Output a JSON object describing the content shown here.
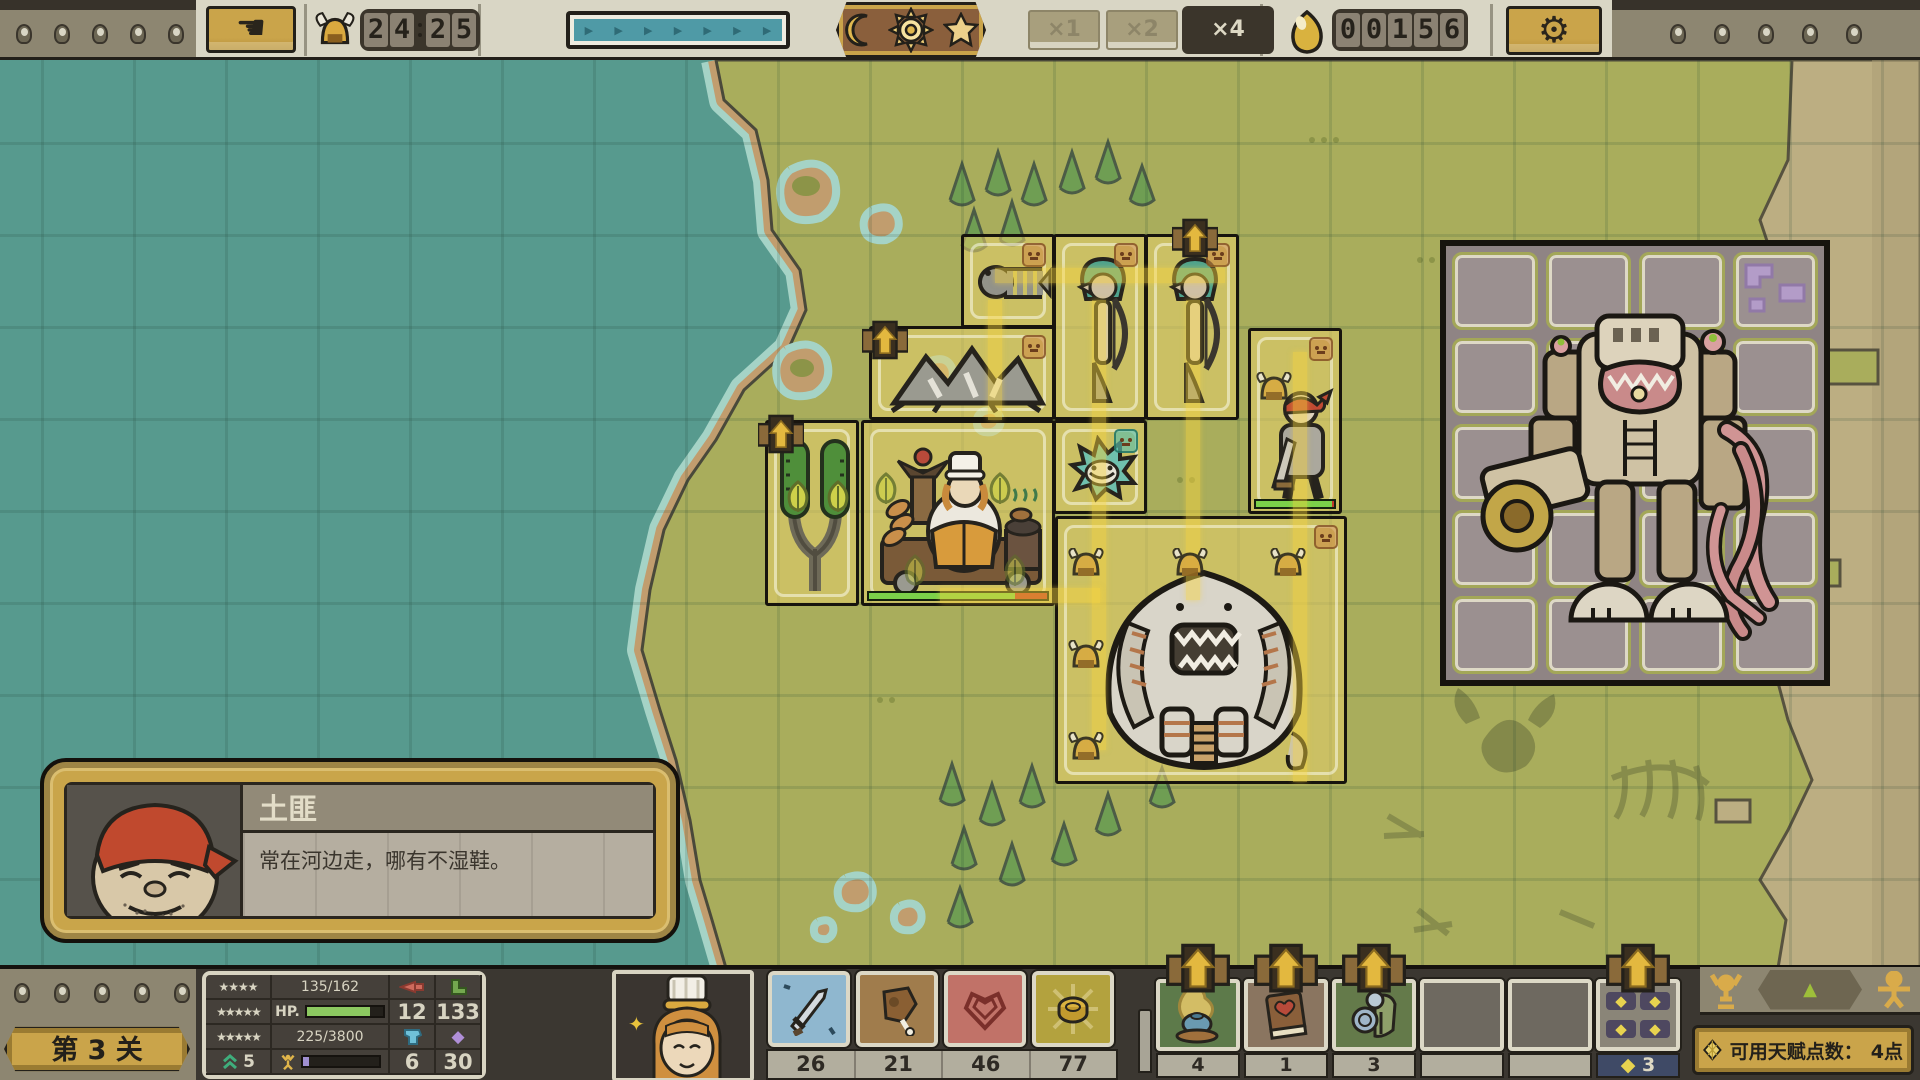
{
  "top_bar": {
    "wave_timer": {
      "digits": [
        "2",
        "4",
        "2",
        "5"
      ]
    },
    "speed_options": [
      {
        "label": "×1",
        "active": false
      },
      {
        "label": "×2",
        "active": false
      },
      {
        "label": "×4",
        "active": true
      }
    ],
    "gold_counter": {
      "digits": [
        "0",
        "0",
        "1",
        "5",
        "6"
      ]
    }
  },
  "map": {
    "units": [
      "fish-skeleton",
      "mermaid-archer",
      "mermaid-archer",
      "rock-spider",
      "slingshot-tree",
      "chef-wagon",
      "bandit-swordsman",
      "spike-fish",
      "behemoth-boss",
      "scrap-mech"
    ]
  },
  "dialog": {
    "title": "土匪",
    "description": "常在河边走，哪有不湿鞋。"
  },
  "bottom_bar": {
    "level_label": "第 3 关",
    "stats": {
      "stars_row1": "★★★★",
      "stars_row2": "★★★★★",
      "stars_row3": "★★★★★",
      "rank_value": "5",
      "hp_value": "135/162",
      "hp_label": "HP.",
      "xp_value": "225/3800",
      "attack": "12",
      "speed": "133",
      "armor": "6",
      "gem": "30"
    },
    "resources": [
      {
        "name": "sword",
        "count": "26"
      },
      {
        "name": "meat",
        "count": "21"
      },
      {
        "name": "heart",
        "count": "46"
      },
      {
        "name": "coin",
        "count": "77"
      }
    ],
    "item_slots": [
      {
        "name": "incense-burner",
        "count": "4"
      },
      {
        "name": "heart-book",
        "count": "1"
      },
      {
        "name": "knight-armor",
        "count": "3"
      },
      {
        "name": "empty",
        "count": ""
      },
      {
        "name": "empty",
        "count": ""
      },
      {
        "name": "talent-diamonds",
        "count": "3"
      }
    ],
    "talent_points_label": "可用天赋点数：",
    "talent_points_value": "4点"
  }
}
